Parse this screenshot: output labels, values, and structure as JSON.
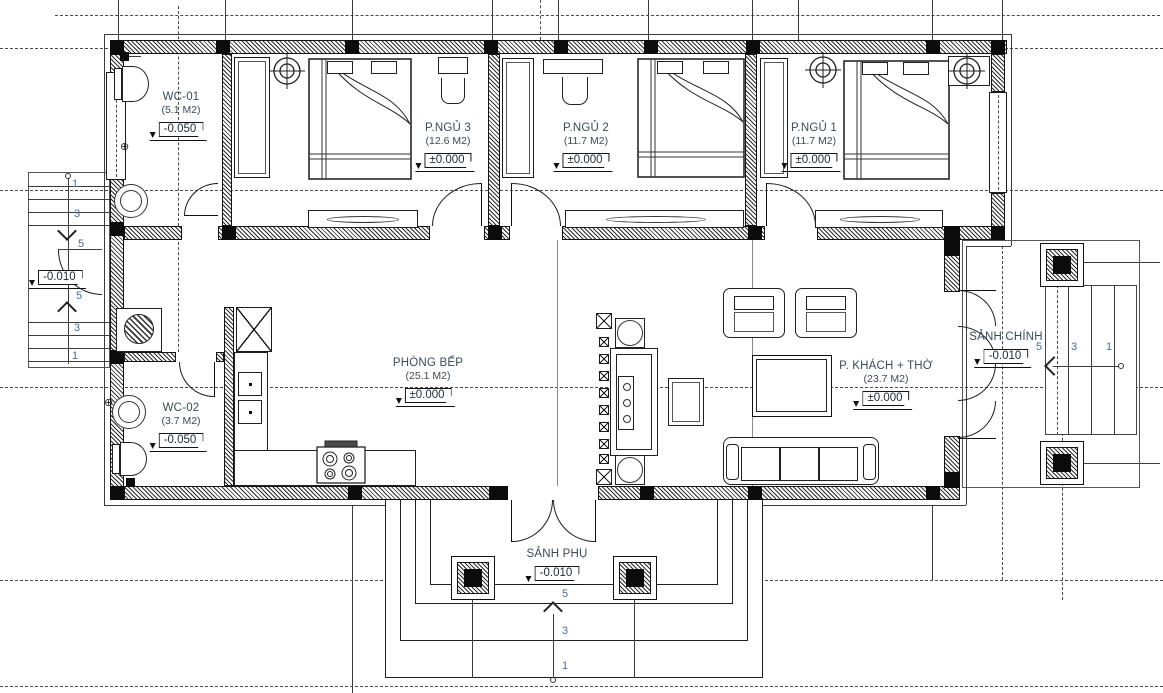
{
  "rooms": {
    "wc1": {
      "name": "WC-01",
      "area": "(5.1 M2)",
      "level": "-0.050"
    },
    "bed3": {
      "name": "P.NGỦ 3",
      "area": "(12.6 M2)",
      "level": "±0.000"
    },
    "bed2": {
      "name": "P.NGỦ 2",
      "area": "(11.7 M2)",
      "level": "±0.000"
    },
    "bed1": {
      "name": "P.NGỦ 1",
      "area": "(11.7 M2)",
      "level": "±0.000"
    },
    "kitchen": {
      "name": "PHÒNG BẾP",
      "area": "(25.1 M2)",
      "level": "±0.000"
    },
    "living": {
      "name": "P. KHÁCH + THỜ",
      "area": "(23.7 M2)",
      "level": "±0.000"
    },
    "wc2": {
      "name": "WC-02",
      "area": "(3.7 M2)",
      "level": "-0.050"
    },
    "main_porch": {
      "name": "SẢNH CHÍNH",
      "level": "-0.010"
    },
    "side_porch": {
      "name": "SẢNH PHỤ",
      "level": "-0.010"
    },
    "left_porch": {
      "level": "-0.010"
    }
  },
  "stairs": {
    "left_top": [
      "1",
      "3",
      "5"
    ],
    "left_bottom": [
      "5",
      "3",
      "1"
    ],
    "main": [
      "5",
      "3",
      "1"
    ],
    "side": [
      "5",
      "3",
      "1"
    ]
  },
  "colors": {
    "wall_line": "#141414",
    "text": "#3a4a58",
    "stair_number": "#4c6b92"
  }
}
